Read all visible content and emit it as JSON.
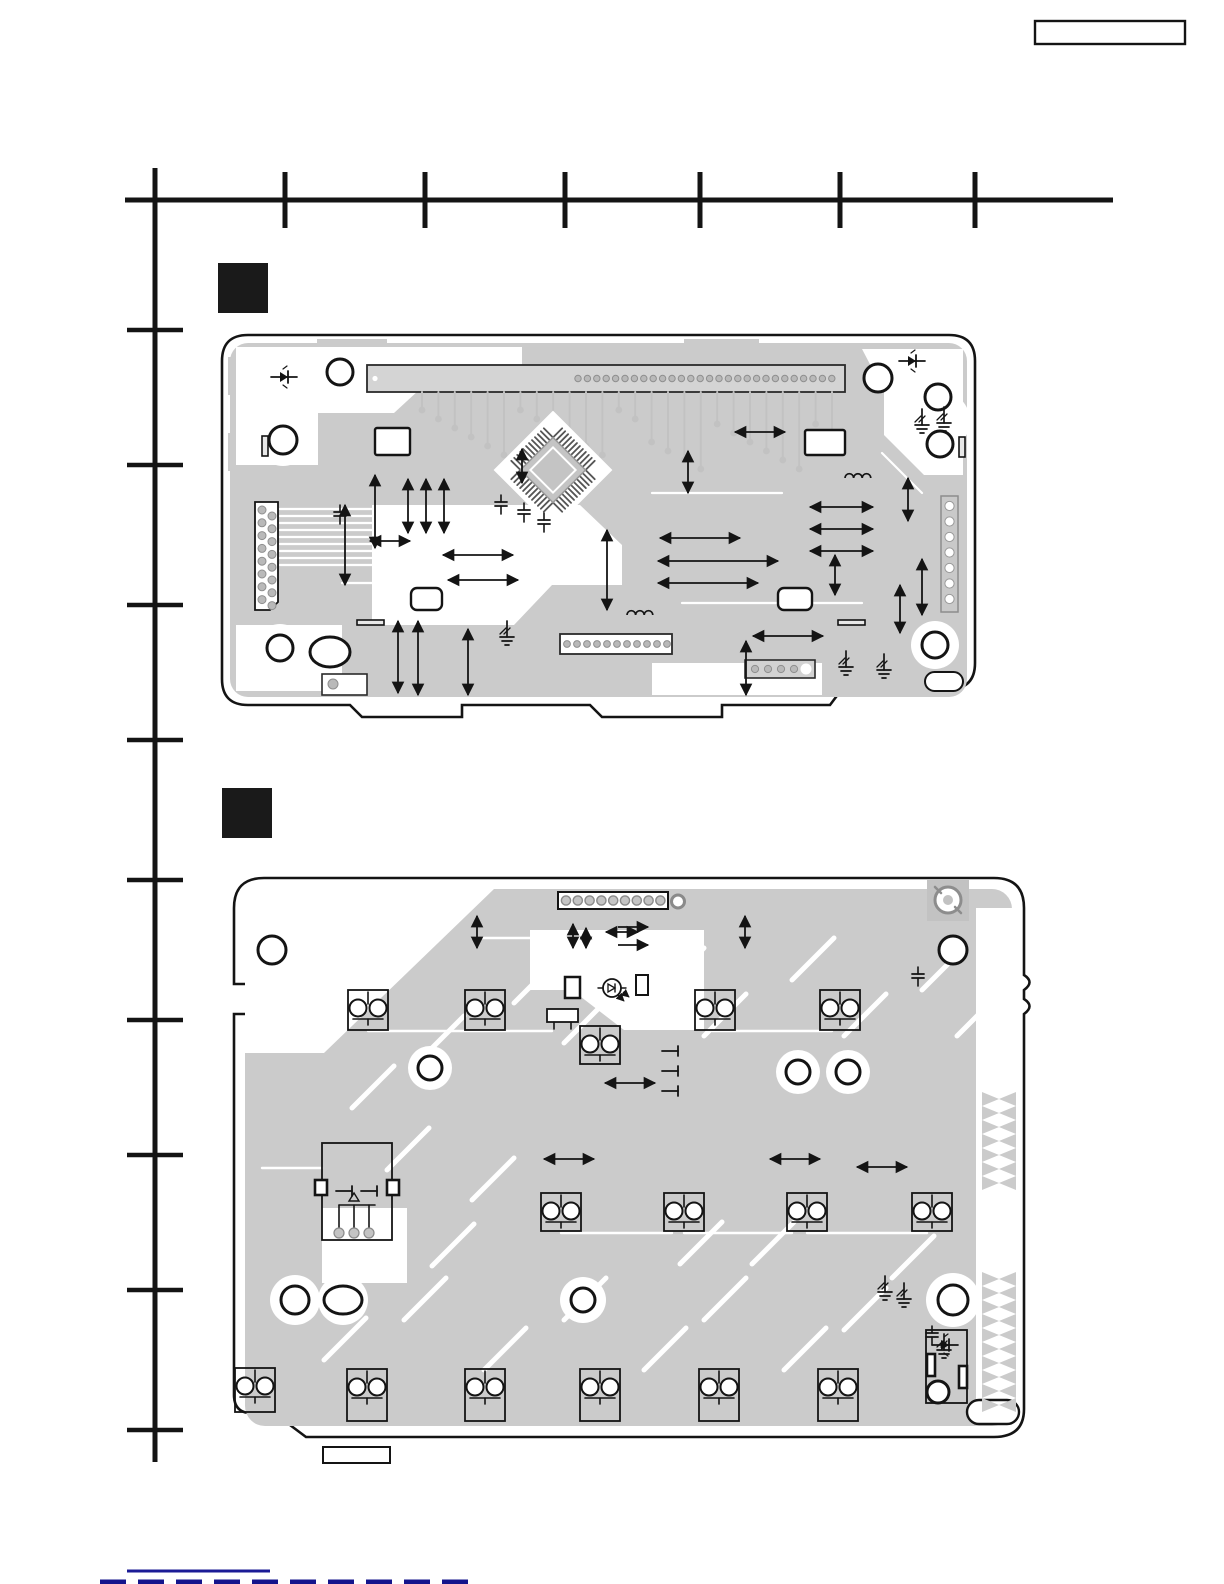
{
  "page": {
    "width": 1224,
    "height": 1584,
    "background": "#ffffff"
  },
  "header": {
    "model_box": {
      "label": "",
      "x": 1035,
      "y": 21,
      "w": 150,
      "h": 23
    }
  },
  "colors": {
    "ink": "#141414",
    "trace": "#cbcbcb",
    "trace_dark": "#bdbdbd",
    "pad": "#b9b9b9",
    "pad_edge": "#8f8f8f",
    "white": "#ffffff",
    "footer_line": "#1b1b96",
    "footer_dash": "#14148c"
  },
  "locator_grid": {
    "top_ruler": {
      "y": 200,
      "x_start": 125,
      "x_end": 1113,
      "ticks_x": [
        285,
        425,
        565,
        700,
        840,
        975
      ],
      "tick_top": 172,
      "tick_bottom": 228,
      "stroke_w": 5
    },
    "left_ruler": {
      "x": 155,
      "y_start": 168,
      "y_end": 1462,
      "ticks_y": [
        330,
        465,
        605,
        740,
        880,
        1020,
        1155,
        1290,
        1430
      ],
      "tick_left": 127,
      "tick_right": 183,
      "stroke_w": 5
    }
  },
  "section_markers": [
    {
      "x": 218,
      "y": 263,
      "w": 50,
      "h": 50
    },
    {
      "x": 222,
      "y": 788,
      "w": 50,
      "h": 50
    }
  ],
  "footer": {
    "label": "",
    "rule": {
      "x1": 127,
      "y1": 1571,
      "x2": 270,
      "y2": 1571,
      "w": 3
    },
    "dash_row": {
      "x1": 100,
      "y1": 1582,
      "x2": 478,
      "y2": 1582,
      "w": 5,
      "dash": "26 12"
    },
    "label_box": {
      "x": 323,
      "y": 1447,
      "w": 67,
      "h": 16
    }
  },
  "pcb1": {
    "x": 222,
    "y": 333,
    "w": 753,
    "h": 388,
    "outline": "M26 2 H727 Q753 2 753 28 V330 Q753 356 727 356 H620 L608 372 H500 V384 H380 L368 372 H240 V384 H140 L128 372 H26 Q0 372 0 346 V28 Q0 2 26 2 Z",
    "gray_inset": {
      "x": 8,
      "y": 10,
      "w": 737,
      "h": 354,
      "r": 18
    },
    "edge_bars_top": [
      {
        "x": 95,
        "y": 6,
        "w": 70,
        "h": 10
      },
      {
        "x": 462,
        "y": 6,
        "w": 75,
        "h": 10
      }
    ],
    "edge_bars_left": [
      {
        "x": 6,
        "y": 24,
        "w": 8,
        "h": 38
      },
      {
        "x": 6,
        "y": 100,
        "w": 8,
        "h": 38
      }
    ],
    "white_blobs": [
      "M14 14 H300 V34 H222 L172 80 H96 V132 H14 Z",
      "M150 172 H358 L400 212 V252 H330 L292 292 H150 Z",
      "M14 292 H120 V358 H14 Z",
      "M640 16 H741 V142 H702 L662 102 V58 Z",
      "M430 330 H600 V362 H430 Z"
    ],
    "white_circle_blobs": [
      {
        "x": 61,
        "y": 107,
        "r": 26
      },
      {
        "x": 718,
        "y": 88,
        "r": 30
      },
      {
        "x": 713,
        "y": 312,
        "r": 24
      },
      {
        "x": 58,
        "y": 315,
        "r": 24
      }
    ],
    "bundle_lines": {
      "x0": 58,
      "y0": 176,
      "dy": 7,
      "lengths": [
        210,
        232,
        252,
        242,
        222,
        262,
        202,
        246,
        216
      ]
    },
    "fan": {
      "n": 26,
      "x0": 200,
      "dx": 16.4,
      "y": 59
    },
    "top_connector": {
      "x": 145,
      "y": 32,
      "w": 478,
      "h": 27,
      "pad_x0": 356,
      "pad_dx": 9.4,
      "pads": 28
    },
    "left_connector": {
      "x": 33,
      "y": 169,
      "w": 23,
      "h": 108,
      "pads": 8
    },
    "right_connector": {
      "x": 719,
      "y": 163,
      "w": 17,
      "h": 116,
      "pads": 7
    },
    "bottom_connector": {
      "x": 338,
      "y": 301,
      "w": 112,
      "h": 20,
      "pads": 11
    },
    "br_connector": {
      "x": 523,
      "y": 327,
      "w": 70,
      "h": 18,
      "pads": 4
    },
    "bl_part": {
      "x": 100,
      "y": 341,
      "w": 45,
      "h": 21
    },
    "rects": [
      {
        "x": 153,
        "y": 95,
        "w": 35,
        "h": 27,
        "r": 2
      },
      {
        "x": 583,
        "y": 97,
        "w": 40,
        "h": 25,
        "r": 2
      },
      {
        "x": 189,
        "y": 255,
        "w": 31,
        "h": 22,
        "r": 6
      },
      {
        "x": 556,
        "y": 255,
        "w": 34,
        "h": 22,
        "r": 6
      }
    ],
    "bars": [
      {
        "x": 135,
        "y": 287,
        "w": 27,
        "h": 5
      },
      {
        "x": 616,
        "y": 287,
        "w": 27,
        "h": 5
      },
      {
        "x": 40,
        "y": 103,
        "w": 6,
        "h": 20
      },
      {
        "x": 737,
        "y": 104,
        "w": 6,
        "h": 20
      }
    ],
    "holes": [
      {
        "x": 118,
        "y": 39,
        "r": 13
      },
      {
        "x": 656,
        "y": 45,
        "r": 14
      },
      {
        "x": 61,
        "y": 107,
        "r": 14
      },
      {
        "x": 716,
        "y": 64,
        "r": 13
      },
      {
        "x": 718,
        "y": 111,
        "r": 13
      },
      {
        "x": 713,
        "y": 312,
        "r": 13
      },
      {
        "x": 58,
        "y": 315,
        "r": 13
      }
    ],
    "oval_holes": [
      {
        "x": 108,
        "y": 319,
        "rx": 20,
        "ry": 15
      }
    ],
    "pills": [
      {
        "x": 703,
        "y": 339,
        "w": 38,
        "h": 19
      }
    ],
    "qfp": {
      "x": 331,
      "y": 137,
      "body": 46,
      "halo": 84,
      "pins_per_side": 12,
      "pin_len": 13
    },
    "arrows_v": [
      [
        153,
        142,
        153,
        215
      ],
      [
        186,
        146,
        186,
        200
      ],
      [
        204,
        146,
        204,
        200
      ],
      [
        222,
        146,
        222,
        200
      ],
      [
        123,
        172,
        123,
        252
      ],
      [
        385,
        197,
        385,
        277
      ],
      [
        300,
        116,
        300,
        150
      ],
      [
        176,
        288,
        176,
        360
      ],
      [
        196,
        288,
        196,
        362
      ],
      [
        246,
        296,
        246,
        362
      ],
      [
        466,
        118,
        466,
        160
      ],
      [
        524,
        308,
        524,
        362
      ],
      [
        686,
        145,
        686,
        188
      ],
      [
        678,
        252,
        678,
        300
      ],
      [
        700,
        226,
        700,
        282
      ],
      [
        613,
        222,
        613,
        262
      ]
    ],
    "arrows_h": [
      [
        221,
        222,
        291,
        222
      ],
      [
        226,
        247,
        296,
        247
      ],
      [
        438,
        205,
        518,
        205
      ],
      [
        436,
        228,
        556,
        228
      ],
      [
        436,
        250,
        536,
        250
      ],
      [
        531,
        303,
        601,
        303
      ],
      [
        588,
        174,
        651,
        174
      ],
      [
        588,
        196,
        651,
        196
      ],
      [
        588,
        218,
        651,
        218
      ],
      [
        513,
        99,
        563,
        99
      ],
      [
        148,
        208,
        188,
        208
      ]
    ],
    "diodes": [
      {
        "x": 62,
        "y": 44
      },
      {
        "x": 690,
        "y": 28
      }
    ],
    "grounds": [
      {
        "x": 285,
        "y": 300
      },
      {
        "x": 624,
        "y": 330
      },
      {
        "x": 662,
        "y": 333
      },
      {
        "x": 700,
        "y": 88
      },
      {
        "x": 722,
        "y": 86
      }
    ],
    "caps": [
      {
        "x": 279,
        "y": 172
      },
      {
        "x": 302,
        "y": 180
      },
      {
        "x": 322,
        "y": 190
      },
      {
        "x": 118,
        "y": 182
      }
    ],
    "inductors": [
      {
        "x": 418,
        "y": 282
      },
      {
        "x": 636,
        "y": 145
      }
    ]
  },
  "pcb2": {
    "x": 232,
    "y": 868,
    "w": 793,
    "h": 570,
    "outline": "M32 10 H762 Q792 10 792 40 V107 q11 7 0 15 v9 q11 7 0 15 V541 Q792 569 762 569 H74 L42 545 L16 545 Q2 543 2 527 V146 H18 V116 H2 V40 Q2 10 32 10 Z",
    "gray_inset": {
      "x": 13,
      "y": 21,
      "w": 767,
      "h": 537,
      "r": 20
    },
    "white_margin_right": {
      "x": 744,
      "y": 40,
      "w": 38,
      "h": 505
    },
    "white_blobs": [
      "M13 21 H262 L92 185 H13 Z",
      "M298 62 L472 62 L472 162 L392 162 L340 122 L298 122 Z",
      "M90 340 L175 340 L175 415 L90 415 Z"
    ],
    "white_circle_blobs": [
      {
        "x": 63,
        "y": 432,
        "r": 25
      },
      {
        "x": 111,
        "y": 432,
        "r": 25
      },
      {
        "x": 351,
        "y": 432,
        "r": 23
      },
      {
        "x": 721,
        "y": 432,
        "r": 27
      },
      {
        "x": 198,
        "y": 200,
        "r": 22
      },
      {
        "x": 566,
        "y": 204,
        "r": 22
      },
      {
        "x": 616,
        "y": 204,
        "r": 22
      }
    ],
    "stripes": [
      [
        120,
        240
      ],
      [
        190,
        190
      ],
      [
        282,
        135
      ],
      [
        332,
        175
      ],
      [
        430,
        122
      ],
      [
        472,
        168
      ],
      [
        560,
        112
      ],
      [
        612,
        168
      ],
      [
        690,
        122
      ],
      [
        725,
        168
      ],
      [
        155,
        302
      ],
      [
        240,
        332
      ],
      [
        92,
        492
      ],
      [
        172,
        452
      ],
      [
        252,
        502
      ],
      [
        332,
        452
      ],
      [
        412,
        502
      ],
      [
        472,
        452
      ],
      [
        552,
        502
      ],
      [
        612,
        462
      ],
      [
        448,
        396
      ],
      [
        520,
        396
      ],
      [
        660,
        410
      ],
      [
        200,
        398
      ]
    ],
    "white_lines": [
      [
        136,
        163,
        320,
        163
      ],
      [
        452,
        365,
        560,
        365
      ],
      [
        30,
        300,
        90,
        300
      ],
      [
        329,
        365,
        440,
        365
      ],
      [
        240,
        70,
        320,
        70
      ],
      [
        480,
        163,
        600,
        163
      ],
      [
        575,
        365,
        695,
        365
      ]
    ],
    "screw_pad": {
      "x": 716,
      "y": 32
    },
    "top_connector": {
      "x": 326,
      "y": 24,
      "w": 110,
      "h": 17,
      "pads": 9,
      "extra_pad_x": 446
    },
    "switches": [
      {
        "x": 136,
        "y": 142,
        "h": 40
      },
      {
        "x": 253,
        "y": 142,
        "h": 40
      },
      {
        "x": 483,
        "y": 142,
        "h": 40
      },
      {
        "x": 608,
        "y": 142,
        "h": 40
      },
      {
        "x": 368,
        "y": 177,
        "h": 38
      },
      {
        "x": 329,
        "y": 344,
        "h": 38
      },
      {
        "x": 452,
        "y": 344,
        "h": 38
      },
      {
        "x": 575,
        "y": 344,
        "h": 38
      },
      {
        "x": 700,
        "y": 344,
        "h": 38
      },
      {
        "x": 23,
        "y": 522,
        "h": 44
      },
      {
        "x": 135,
        "y": 527,
        "h": 52
      },
      {
        "x": 253,
        "y": 527,
        "h": 52
      },
      {
        "x": 368,
        "y": 527,
        "h": 52
      },
      {
        "x": 487,
        "y": 527,
        "h": 52
      },
      {
        "x": 606,
        "y": 527,
        "h": 52
      }
    ],
    "jack": {
      "x": 90,
      "y": 275,
      "w": 70,
      "h": 97
    },
    "small_rects": [
      {
        "x": 333,
        "y": 109,
        "w": 15,
        "h": 21,
        "sw": 2.5
      },
      {
        "x": 404,
        "y": 107,
        "w": 12,
        "h": 20,
        "sw": 2
      }
    ],
    "legs_part": {
      "x": 315,
      "y": 141,
      "w": 31,
      "h": 13
    },
    "led": {
      "x": 380,
      "y": 120
    },
    "br_component": {
      "x": 694,
      "y": 462,
      "w": 41,
      "h": 73
    },
    "holes": [
      {
        "x": 40,
        "y": 82,
        "r": 14
      },
      {
        "x": 721,
        "y": 82,
        "r": 14
      },
      {
        "x": 198,
        "y": 200,
        "r": 12
      },
      {
        "x": 566,
        "y": 204,
        "r": 12
      },
      {
        "x": 616,
        "y": 204,
        "r": 12
      },
      {
        "x": 63,
        "y": 432,
        "r": 14
      },
      {
        "x": 351,
        "y": 432,
        "r": 12
      },
      {
        "x": 721,
        "y": 432,
        "r": 15
      },
      {
        "x": 706,
        "y": 524,
        "r": 11
      }
    ],
    "oval_holes": [
      {
        "x": 111,
        "y": 432,
        "rx": 19,
        "ry": 14
      }
    ],
    "pills": [
      {
        "x": 735,
        "y": 532,
        "w": 52,
        "h": 24
      }
    ],
    "zigzag_bands": [
      {
        "x": 750,
        "y1": 224,
        "y2": 322
      },
      {
        "x": 750,
        "y1": 404,
        "y2": 544
      }
    ],
    "arrows_v": [
      [
        245,
        48,
        245,
        80
      ],
      [
        341,
        56,
        341,
        80
      ],
      [
        354,
        60,
        354,
        80
      ],
      [
        513,
        48,
        513,
        80
      ]
    ],
    "arrows_h": [
      [
        374,
        64,
        406,
        64
      ],
      [
        312,
        291,
        362,
        291
      ],
      [
        625,
        299,
        675,
        299
      ],
      [
        373,
        215,
        423,
        215
      ],
      [
        538,
        291,
        588,
        291
      ]
    ],
    "arrows_h_single": [
      [
        386,
        59,
        416,
        59
      ],
      [
        386,
        77,
        416,
        77
      ]
    ],
    "grounds": [
      {
        "x": 653,
        "y": 420
      },
      {
        "x": 672,
        "y": 427
      },
      {
        "x": 712,
        "y": 478
      }
    ],
    "caps": [
      {
        "x": 686,
        "y": 109
      },
      {
        "x": 700,
        "y": 468
      }
    ],
    "cap_marks": [
      {
        "x": 438,
        "y": 183
      },
      {
        "x": 438,
        "y": 203
      },
      {
        "x": 438,
        "y": 223
      }
    ]
  }
}
